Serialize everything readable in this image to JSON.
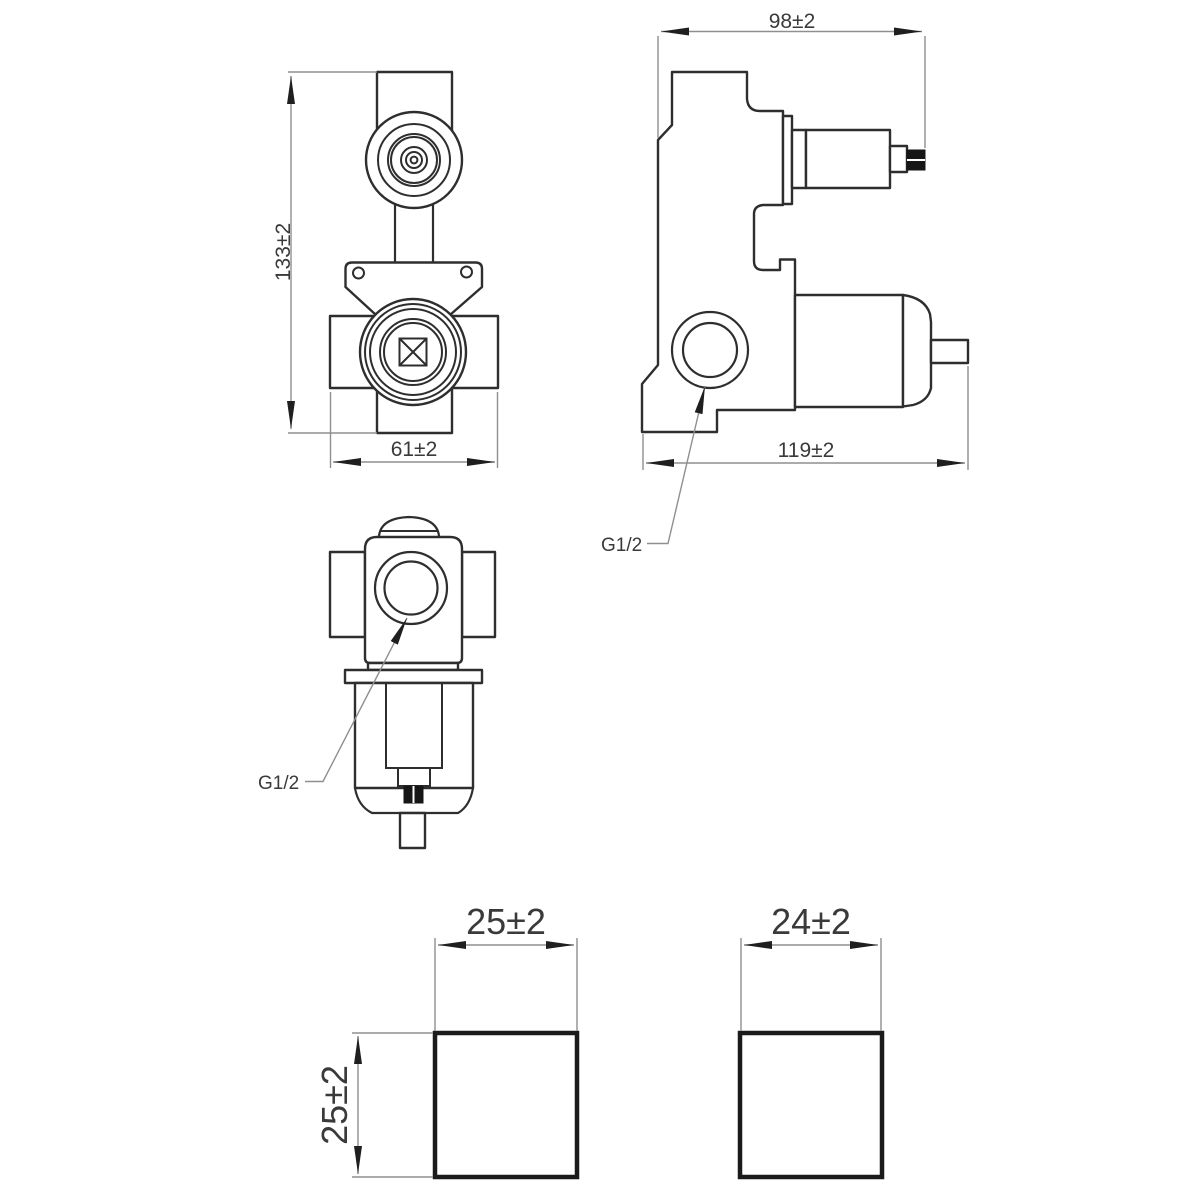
{
  "drawing": {
    "views": {
      "front": {
        "name": "front-elevation",
        "height_dim": "133±2",
        "width_dim": "61±2"
      },
      "side": {
        "name": "side-elevation",
        "top_width_dim": "98±2",
        "bottom_width_dim": "119±2",
        "port_label": "G1/2"
      },
      "top": {
        "name": "top-plan",
        "port_label": "G1/2"
      },
      "handle_front": {
        "name": "handle-front-face",
        "width_dim": "25±2",
        "height_dim": "25±2"
      },
      "handle_side": {
        "name": "handle-side-face",
        "width_dim": "24±2"
      }
    },
    "colors": {
      "outline": "#2e2e2e",
      "dimension_line": "#8f8f8f",
      "arrow": "#1f1f1f",
      "text": "#3a3a3a",
      "background": "#ffffff",
      "thread_fill": "#161616"
    }
  }
}
